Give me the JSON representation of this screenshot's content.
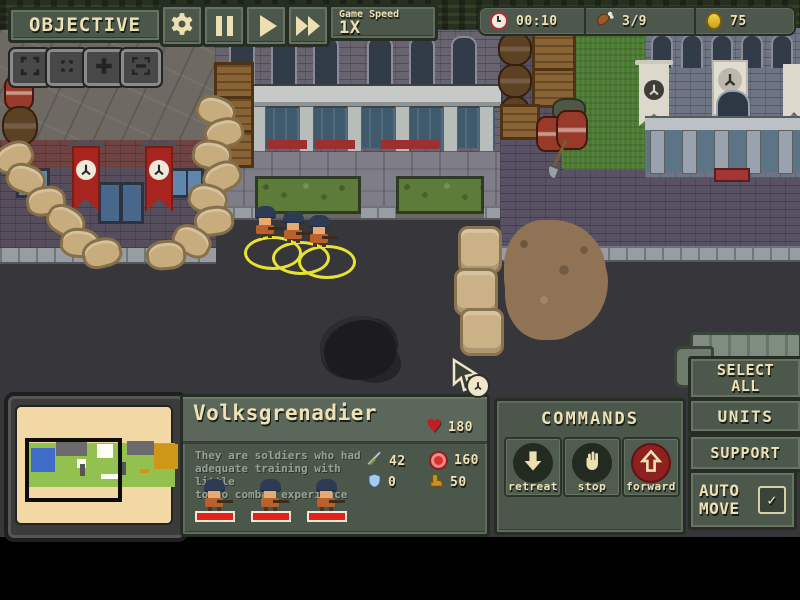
{
  "toolbar": {
    "objective": "OBJECTIVE",
    "speed_label": "Game Speed",
    "speed_value": "1X"
  },
  "status": {
    "time": "00:10",
    "rations": "3/9",
    "coins": "75"
  },
  "unit_panel": {
    "title": "Volksgrenadier",
    "description": "They are soldiers who had\nadequate training with little\nto no combat experience",
    "health": "180",
    "attack": "42",
    "cost": "160",
    "armor": "0",
    "speed": "50",
    "unit_count": 3
  },
  "commands": {
    "title": "COMMANDS",
    "retreat_label": "retreat",
    "stop_label": "stop",
    "forward_label": "forward",
    "active_command": "forward"
  },
  "side_panel": {
    "select_all": "SELECT\nALL",
    "units": "UNITS",
    "support": "SUPPORT",
    "auto_move": "AUTO\nMOVE",
    "auto_move_checked": true,
    "check_glyph": "✓"
  },
  "glyphs": {
    "heart": "♥"
  },
  "icons": {
    "top": [
      "gear-icon",
      "pause-icon",
      "play-icon",
      "fast-forward-icon"
    ],
    "map_controls": [
      "expand-icon",
      "center-icon",
      "zoom-in-icon",
      "zoom-out-icon"
    ],
    "status": [
      "clock-icon",
      "drumstick-icon",
      "coin-icon"
    ],
    "unit_stats": [
      "heart-icon",
      "sword-icon",
      "roundel-icon",
      "shield-icon",
      "boot-icon"
    ],
    "commands": [
      "down-arrow-icon",
      "hand-icon",
      "up-arrow-icon"
    ]
  },
  "colors": {
    "panel_olive": "#4c574b",
    "text_cream": "#eee1b6",
    "command_active_red": "#8e2020",
    "banner_red": "#a8241f",
    "selection_yellow": "#e6e332",
    "road": "#37373b",
    "grass": "#4c7a33",
    "sandbag": "#c7ac7e",
    "minimap_paper": "#f2d8a4"
  }
}
